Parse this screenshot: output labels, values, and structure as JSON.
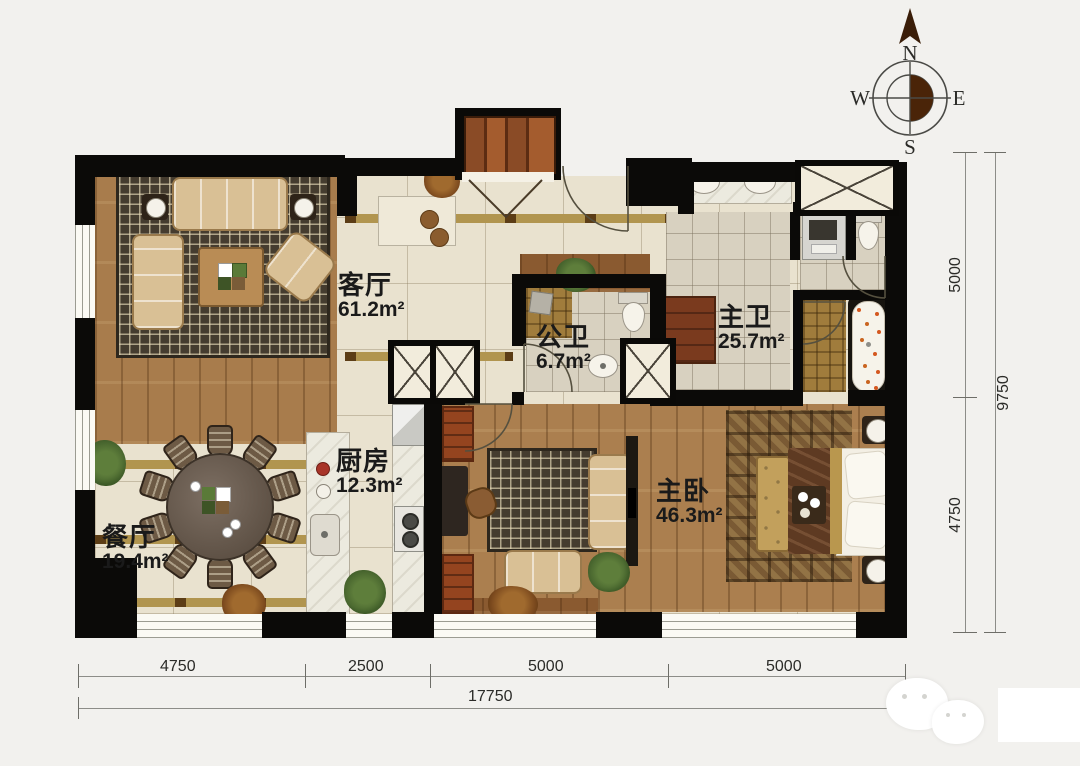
{
  "compass": {
    "n": "N",
    "e": "E",
    "s": "S",
    "w": "W"
  },
  "rooms": [
    {
      "key": "living-room",
      "name": "客厅",
      "area": "61.2m²"
    },
    {
      "key": "public-bathroom",
      "name": "公卫",
      "area": "6.7m²"
    },
    {
      "key": "master-bathroom",
      "name": "主卫",
      "area": "25.7m²"
    },
    {
      "key": "kitchen",
      "name": "厨房",
      "area": "12.3m²"
    },
    {
      "key": "dining-room",
      "name": "餐厅",
      "area": "19.4m²"
    },
    {
      "key": "master-bedroom",
      "name": "主卧",
      "area": "46.3m²"
    }
  ],
  "dimensions": {
    "bottom_segments": [
      "4750",
      "2500",
      "5000",
      "5000"
    ],
    "bottom_total": "17750",
    "right_segments": [
      "5000",
      "4750"
    ],
    "right_total": "9750"
  },
  "colors": {
    "wall": "#0b0a08",
    "tile_floor": "#e9e2cf",
    "wood_floor": "#a87c4c",
    "accent_band": "#b1954f",
    "rug_dark": "#453c2f",
    "compass_fill": "#4a2408"
  }
}
